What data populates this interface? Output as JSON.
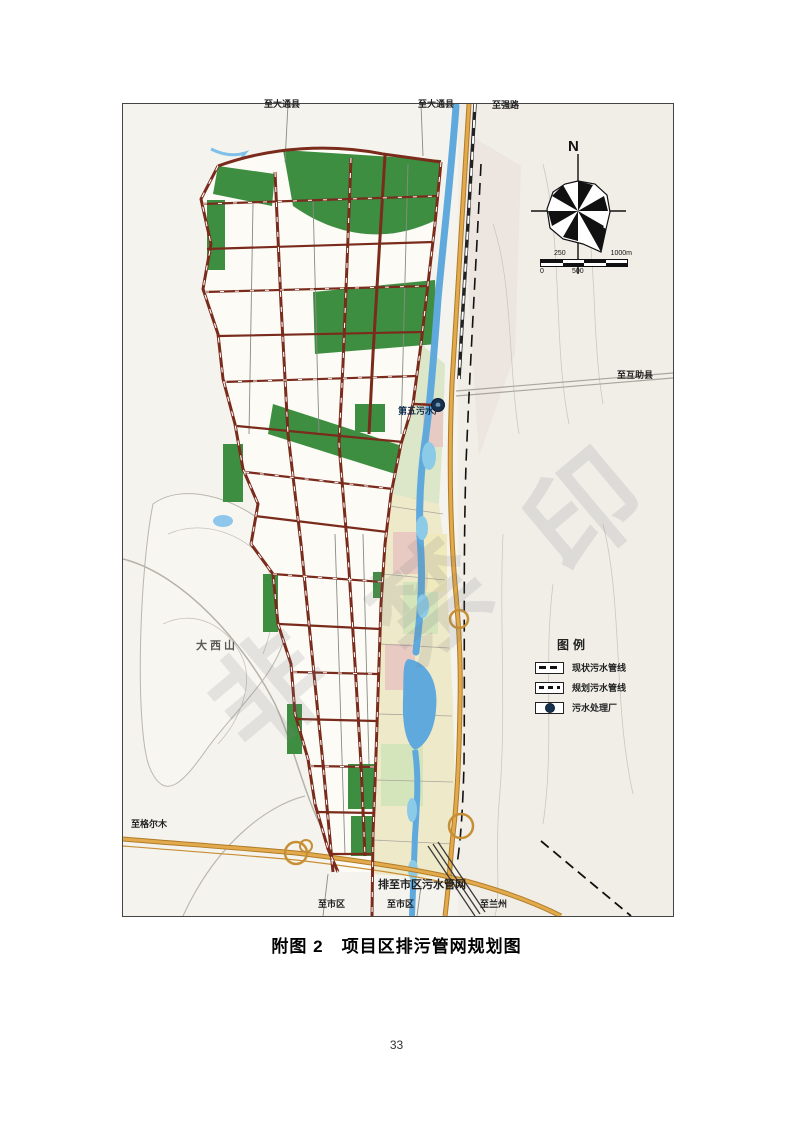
{
  "page": {
    "number": "33"
  },
  "caption": "附图 2　项目区排污管网规划图",
  "map": {
    "compass_north": "N",
    "scale_bar": {
      "label_250": "250",
      "label_1000m": "1000m",
      "label_0": "0",
      "label_500": "500"
    },
    "legend": {
      "title": "图例",
      "items": [
        {
          "label": "现状污水管线"
        },
        {
          "label": "规划污水管线"
        },
        {
          "label": "污水处理厂"
        }
      ]
    },
    "labels": {
      "to_datong_west": "至大通县",
      "to_datong_east": "至大通县",
      "to_qianglu": "至强路",
      "to_huzhu": "至互助县",
      "plant": "第五污水厂",
      "mountain": "大西山",
      "to_geermu": "至格尔木",
      "outfall": "排至市区污水管网",
      "to_city_1": "至市区",
      "to_city_2": "至市区",
      "to_lanzhou": "至兰州"
    },
    "watermark_chars": [
      "非",
      "禁",
      "印"
    ],
    "colors": {
      "pipeline": "#7a2b1c",
      "river": "#5fa9dc",
      "highway": "#d69a3c",
      "greenery": "#3e8e41",
      "plant_marker": "#16324f"
    }
  }
}
